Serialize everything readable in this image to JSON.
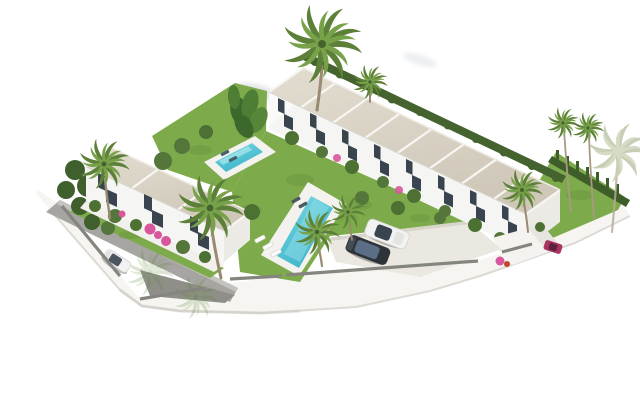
{
  "meta": {
    "title": "Residential development aerial render",
    "description": "3D aerial architectural rendering of a white Mediterranean townhouse development: a long row of eight terraced houses with beige pitched roofs, a smaller three-unit block on the left, communal turquoise swimming pool and plunge pool, green lawns, palm trees, perimeter white wall, a grey access road with a parked white car, and a parking area with a white car and a dark car near the gated entrance."
  },
  "scene": {
    "buildings": {
      "row_units": 8,
      "left_block_units": 3,
      "roof_color": "#d9d3c6",
      "facade_color": "#f5f5f3",
      "window_color": "#39444e"
    },
    "landscape": {
      "lawn_color": "#7daa4a",
      "hedge_color": "#44632e",
      "palm_frond_color": "#5d8038",
      "palm_trunk_color": "#9a8a72",
      "flower_color": "#d8569b",
      "palm_tree_count": 10
    },
    "pools": [
      {
        "name": "main-pool",
        "water_color": "#57c6d6"
      },
      {
        "name": "plunge-pool",
        "water_color": "#57c6d6"
      }
    ],
    "vehicles": [
      {
        "name": "white-car-parking",
        "color": "#f2f2f2"
      },
      {
        "name": "dark-car-parking",
        "color": "#2e3338"
      },
      {
        "name": "white-car-road",
        "color": "#ffffff"
      },
      {
        "name": "red-vehicle-entrance",
        "color": "#a8345f"
      }
    ],
    "hardscape": {
      "road_color": "#a6a5a1",
      "parking_color": "#eae8e1",
      "wall_color": "#f6f5f1",
      "wall_cap_color": "#85857f",
      "deck_color": "#f3f2ee"
    }
  },
  "css_vars": {
    "--roof": "#d9d3c6",
    "--facade": "#f5f5f3",
    "--facade-shade": "#ebeae5",
    "--window": "#39444e",
    "--lawn": "#7daa4a",
    "--lawn-dark": "#5d8736",
    "--hedge": "#44632e",
    "--palm": "#5d8038",
    "--palm-light": "#78a24a",
    "--trunk": "#9a8a72",
    "--pool": "#57c6d6",
    "--pool-light": "#9fe2ea",
    "--deck": "#f3f2ee",
    "--road": "#a6a5a1",
    "--road-dark": "#8f8e89",
    "--parking": "#eae8e1",
    "--wall": "#f6f5f1",
    "--wallcap": "#85857f",
    "--flower": "#d8569b",
    "--car-dark": "#2e3338",
    "--car-white": "#f2f2f2",
    "--car-red": "#a8345f"
  }
}
